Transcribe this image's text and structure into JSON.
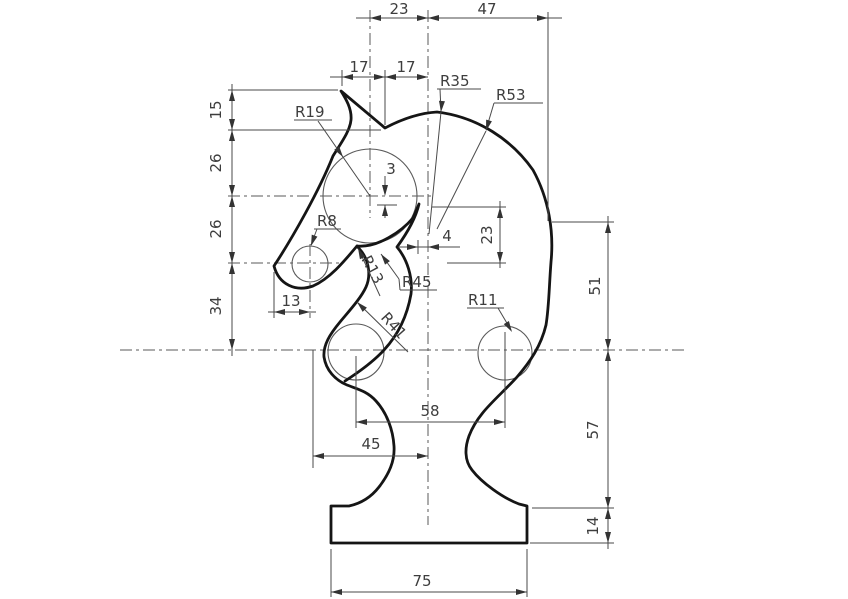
{
  "drawing": {
    "title": "chess-knight-dimensioned-drawing",
    "dims": {
      "top": [
        "23",
        "47"
      ],
      "ear": [
        "17",
        "17"
      ],
      "left": [
        "15",
        "26",
        "26",
        "34"
      ],
      "nose_offset": "13",
      "eye_offset": "3",
      "throat_offset": "4",
      "mouth_depth": "23",
      "right": [
        "51",
        "57",
        "14"
      ],
      "circle_span": "58",
      "stem_span": "45",
      "base_width": "75"
    },
    "radii": {
      "r19": "R19",
      "r35": "R35",
      "r53": "R53",
      "r8": "R8",
      "r13": "R13",
      "r45": "R45",
      "r41": "R41",
      "r11": "R11"
    },
    "colors": {
      "line": "#151515",
      "thin": "#4a4a4a",
      "background": "#ffffff"
    }
  }
}
